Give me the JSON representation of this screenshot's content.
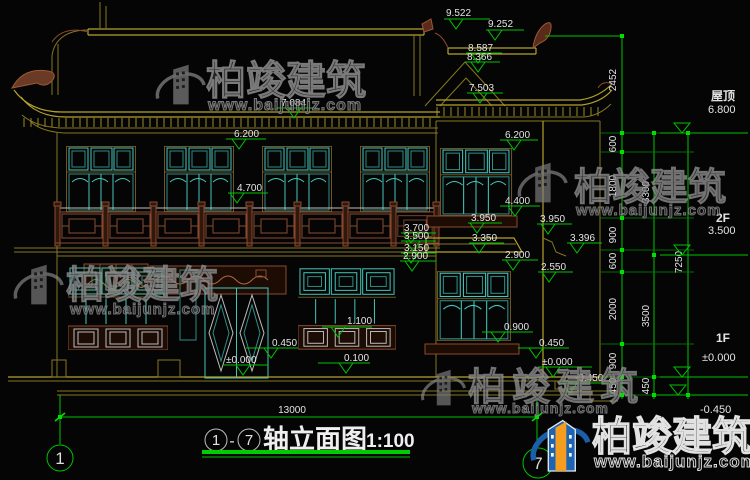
{
  "colors": {
    "background": "#050505",
    "dim_green": "#00c400",
    "structure_yellow": "#b3a22c",
    "window_teal": "#45c8bc",
    "wood_brown": "#8a4a30",
    "text_white": "#e4e4e4",
    "logo_blue": "#1c64b4",
    "logo_orange": "#f59d1e"
  },
  "watermark": {
    "brand": "柏竣建筑",
    "url": "www.baijunjz.com"
  },
  "marks": [
    "9.522",
    "9.252",
    "8.587",
    "8.366",
    "7.503",
    "7.084",
    "6.200",
    "6.200",
    "4.700",
    "4.400",
    "3.950",
    "3.950",
    "3.700",
    "3.500",
    "3.396",
    "3.350",
    "3.150",
    "2.900",
    "2.900",
    "2.550",
    "1.100",
    "0.450",
    "0.100",
    "±0.000",
    "0.900",
    "0.450",
    "±0.000",
    "-0.450"
  ],
  "right_levels": {
    "roof_label": "屋顶",
    "roof_elev": "6.800",
    "f2_label": "2F",
    "f2_elev": "3.500",
    "f1_label": "1F",
    "f1_elev": "±0.000",
    "ground_elev": "-0.450"
  },
  "chains": {
    "inner": [
      "2452",
      "600",
      "1800",
      "900",
      "600",
      "2000",
      "900",
      "450"
    ],
    "middle": [
      "3300",
      "3500",
      "450"
    ],
    "outer": [
      "7250"
    ]
  },
  "bottom": {
    "overall": "13000",
    "axis_left": "1",
    "axis_right": "7"
  },
  "title": {
    "axis_start": "1",
    "dash": "-",
    "axis_end": "7",
    "name": "轴立面图",
    "scale": "1:100"
  }
}
